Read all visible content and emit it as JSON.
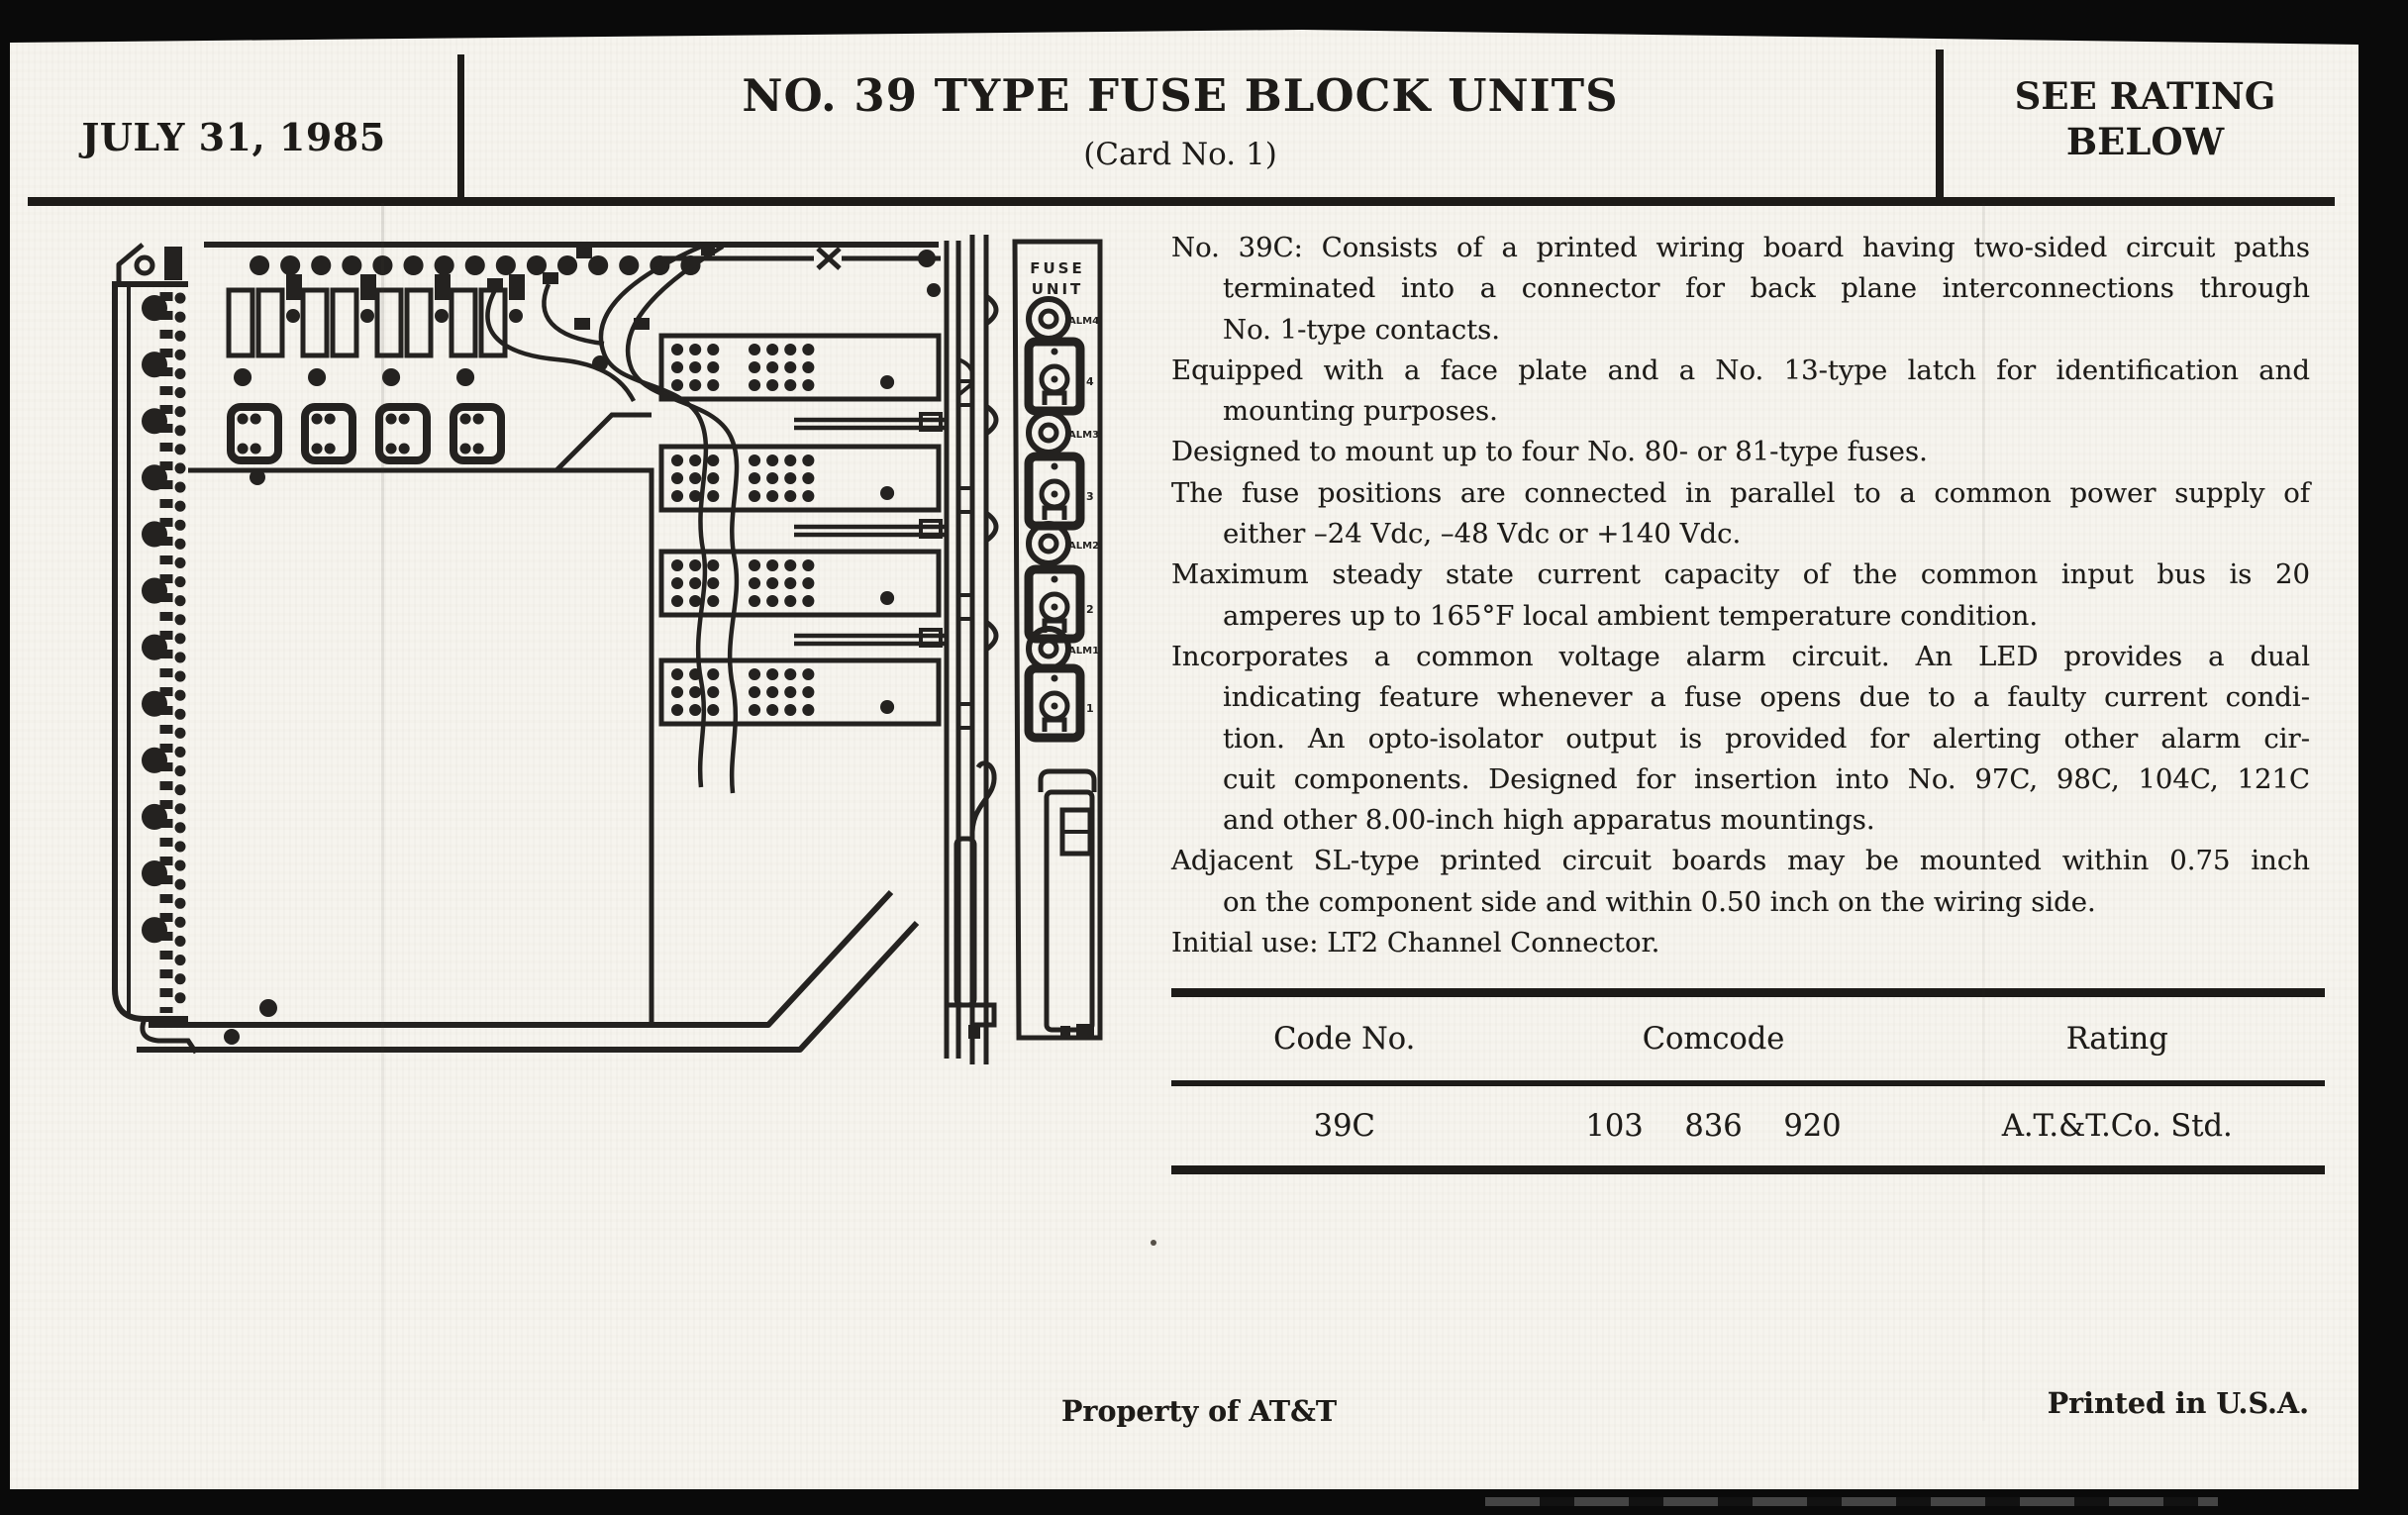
{
  "page": {
    "date": "JULY 31, 1985",
    "title": "NO. 39 TYPE FUSE BLOCK UNITS",
    "subtitle": "(Card No. 1)",
    "rating_note": [
      "SEE RATING",
      "BELOW"
    ]
  },
  "body": {
    "lines": [
      "No. 39C: Consists of a printed wiring board having two-sided circuit paths",
      "terminated into a connector for back plane interconnections through",
      "No. 1-type contacts.",
      "Equipped with a face plate and a No. 13-type latch for identification and",
      "mounting purposes.",
      "Designed to mount up to four No. 80- or 81-type fuses.",
      "The fuse positions are connected in parallel to a common power supply of",
      "either –24 Vdc, –48 Vdc or +140 Vdc.",
      "Maximum steady state current capacity of the common input bus is 20",
      "amperes up to 165°F local ambient temperature condition.",
      "Incorporates a common voltage alarm circuit. An LED provides a dual",
      "indicating feature whenever a fuse opens due to a faulty current condi-",
      "tion. An opto-isolator output is provided for alerting other alarm cir-",
      "cuit components. Designed for insertion into No. 97C, 98C, 104C, 121C",
      "and other 8.00-inch high apparatus mountings.",
      "Adjacent SL-type printed circuit boards may be mounted within 0.75 inch",
      "on the component side and within 0.50 inch on the wiring side.",
      "Initial use: LT2 Channel Connector."
    ]
  },
  "panel": {
    "title": [
      "FUSE",
      "UNIT"
    ],
    "alarm_labels": [
      "ALM4",
      "ALM3",
      "ALM2",
      "ALM1"
    ],
    "fuse_numbers": [
      "4",
      "3",
      "2",
      "1"
    ]
  },
  "table": {
    "headers": [
      "Code No.",
      "Comcode",
      "Rating"
    ],
    "rows": [
      [
        "39C",
        "103 836 920",
        "A.T.&T.Co. Std."
      ]
    ]
  },
  "footer": {
    "left": "Property of AT&T",
    "right": "Printed in U.S.A."
  }
}
